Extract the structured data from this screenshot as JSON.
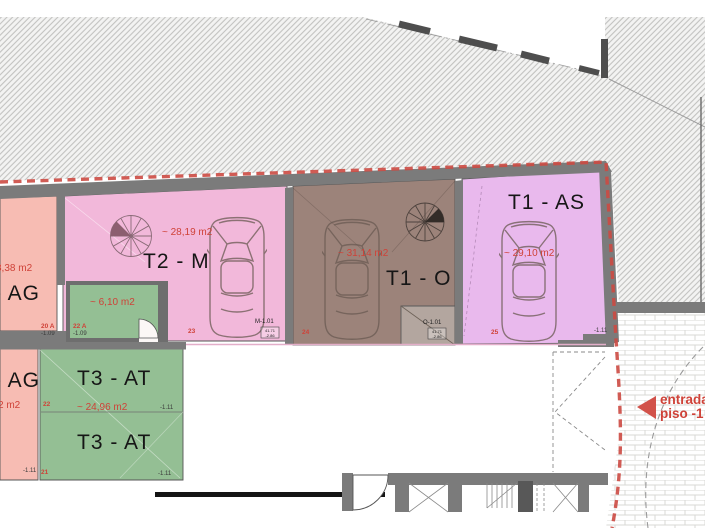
{
  "units": {
    "ag_upper": {
      "label": "- AG",
      "area": "8,38 m2",
      "stall": "20 A",
      "level": "-1.09"
    },
    "t2_m": {
      "label": "T2 - M",
      "area": "~ 28,19 m2",
      "stall": "23",
      "tag": "M-1.01",
      "tag_box_line1": "41.71",
      "tag_box_line2": "-2.86"
    },
    "storage": {
      "area": "~ 6,10 m2",
      "stall": "22 A",
      "level": "-1.09"
    },
    "t1_o": {
      "label": "T1 - O",
      "area": "~ 31,14 m2",
      "stall": "24",
      "tag": "O-1.01",
      "tag_box_line1": "41.71",
      "tag_box_line2": "-2.86"
    },
    "t1_as": {
      "label": "T1 - AS",
      "area": "~ 29,10 m2",
      "stall": "25",
      "level": "-1.11"
    },
    "ag_lower": {
      "label": "- AG",
      "area": "2 m2",
      "level": "-1.11"
    },
    "t3_at": {
      "label_top": "T3 - AT",
      "label_bottom": "T3 - AT",
      "area": "~ 24,96 m2",
      "stall_top": "22",
      "stall_bottom": "21",
      "level_top": "-1.11",
      "level_bottom": "-1.11"
    }
  },
  "entrance": {
    "line1": "entrada",
    "line2": "piso -1"
  },
  "colors": {
    "salmon": "#f7bcb3",
    "pink": "#f2b8da",
    "green": "#94bf94",
    "brown": "#9c837a",
    "purple": "#e9b9ed",
    "red_accent": "#cf4238",
    "wall_gray": "#7b7b7b"
  }
}
